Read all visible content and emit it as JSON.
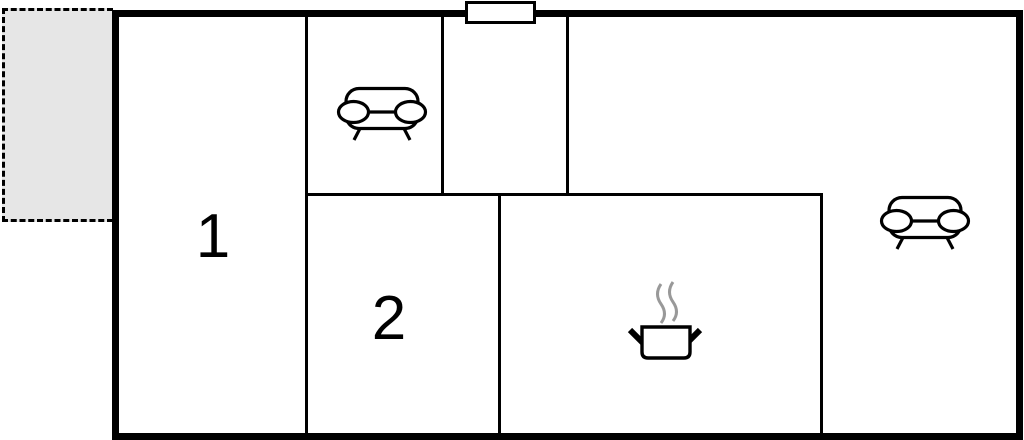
{
  "page": {
    "title": "Floor plan",
    "background_color": "#ffffff"
  },
  "floorplan": {
    "wall_color": "#000000",
    "rooms": [
      {
        "name": "room-1",
        "label": "1"
      },
      {
        "name": "room-2",
        "label": "2"
      }
    ],
    "terrace": {
      "fill_color": "#e6e6e6",
      "border_color": "#000000",
      "border_style": "dashed"
    },
    "window": {
      "icon": "window-marker",
      "fill_color": "#ffffff",
      "border_color": "#000000"
    },
    "furniture": [
      {
        "icon": "sofa-icon",
        "location": "upper-middle-room"
      },
      {
        "icon": "sofa-icon",
        "location": "living-area"
      },
      {
        "icon": "cooking-pot-icon",
        "location": "kitchen-area",
        "pot_color": "#000000",
        "steam_color": "#999999"
      }
    ]
  }
}
